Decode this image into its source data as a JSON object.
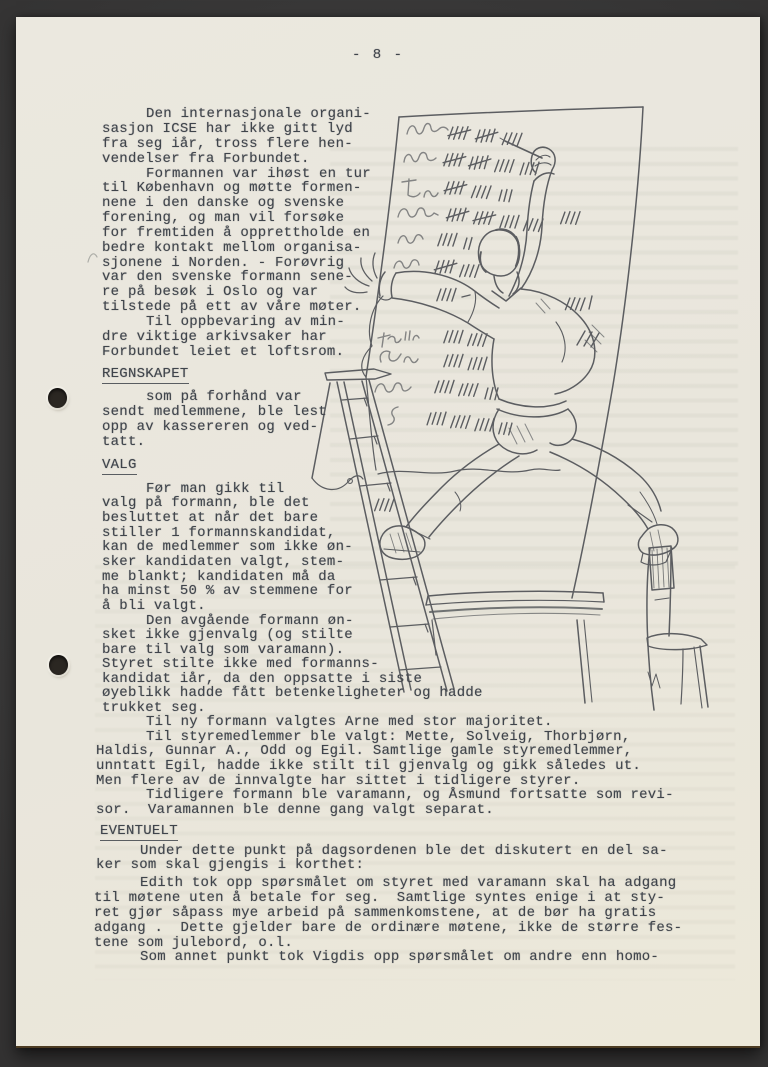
{
  "page": {
    "number": "- 8 -"
  },
  "colors": {
    "backdrop": "#3a3a3a",
    "paper": "#eae7de",
    "ink": "#3f444b"
  },
  "illustration": {
    "alt": "Hand-drawn cartoon: a man stands astride a stepladder and a chair back, writing tally marks beside scribbled names on a large vote board; a table stands below"
  },
  "doc": {
    "lines": [
      "- 8 -",
      "Den internasjonale organi-",
      "sasjon ICSE har ikke gitt lyd",
      "fra seg iår, tross flere hen-",
      "vendelser fra Forbundet.",
      "Formannen var ihøst en tur",
      "til København og møtte formen-",
      "nene i den danske og svenske",
      "forening, og man vil forsøke",
      "for fremtiden å opprettholde en",
      "bedre kontakt mellom organisa-",
      "sjonene i Norden. - Forøvrig",
      "var den svenske formann sene-",
      "re på besøk i Oslo og var",
      "tilstede på ett av våre møter.",
      "Til oppbevaring av min-",
      "dre viktige arkivsaker har",
      "Forbundet leiet et loftsrom.",
      "REGNSKAPET",
      "som på forhånd var",
      "sendt medlemmene, ble lest",
      "opp av kassereren og ved-",
      "tatt.",
      "VALG",
      "Før man gikk til",
      "valg på formann, ble det",
      "besluttet at når det bare",
      "stiller 1 formannskandidat,",
      "kan de medlemmer som ikke øn-",
      "sker kandidaten valgt, stem-",
      "me blankt; kandidaten må da",
      "ha minst 50 % av stemmene for",
      "å bli valgt.",
      "Den avgående formann øn-",
      "sket ikke gjenvalg (og stilte",
      "bare til valg som varamann).",
      "Styret stilte ikke med formanns-",
      "kandidat iår, da den oppsatte i siste",
      "øyeblikk hadde fått betenkeligheter og hadde",
      "trukket seg.",
      "Til ny formann valgtes Arne med stor majoritet.",
      "Til styremedlemmer ble valgt: Mette, Solveig, Thorbjørn,",
      "Haldis, Gunnar A., Odd og Egil. Samtlige gamle styremedlemmer,",
      "unntatt Egil, hadde ikke stilt til gjenvalg og gikk således ut.",
      "Men flere av de innvalgte har sittet i tidligere styrer.",
      "Tidligere formann ble varamann, og Åsmund fortsatte som revi-",
      "sor.  Varamannen ble denne gang valgt separat.",
      "EVENTUELT",
      "Under dette punkt på dagsordenen ble det diskutert en del sa-",
      "ker som skal gjengis i korthet:",
      "Edith tok opp spørsmålet om styret med varamann skal ha adgang",
      "til møtene uten å betale for seg.  Samtlige syntes enige i at sty-",
      "ret gjør såpass mye arbeid på sammenkomstene, at de bør ha gratis",
      "adgang .  Dette gjelder bare de ordinære møtene, ikke de større fes-",
      "tene som julebord, o.l.",
      "Som annet punkt tok Vigdis opp spørsmålet om andre enn homo-"
    ]
  }
}
